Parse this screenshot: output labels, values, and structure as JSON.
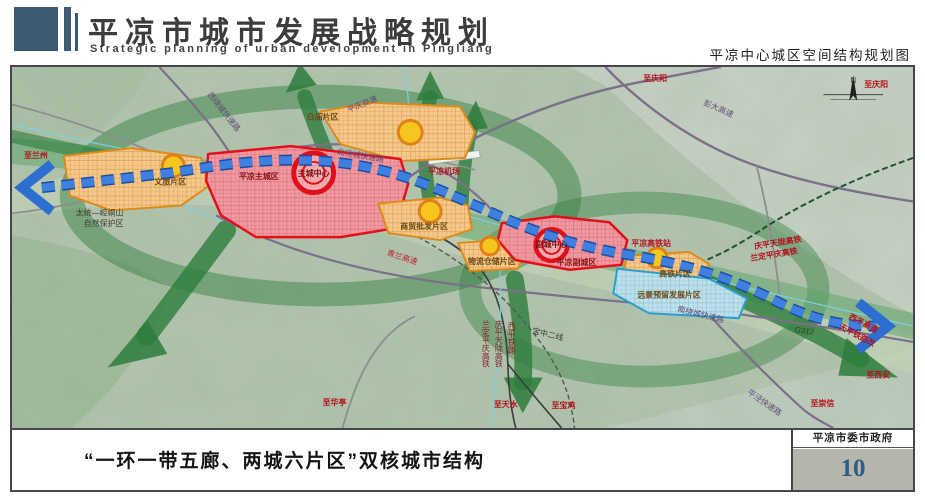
{
  "header": {
    "title": "平凉市城市发展战略规划",
    "subtitle_en": "Strategic planning of urban development in Pingliang",
    "map_title": "平凉中心城区空间结构规划图"
  },
  "footer": {
    "caption": "“一环一带五廊、两城六片区”双核城市结构",
    "agency": "平凉市委市政府",
    "page_number": "10"
  },
  "colors": {
    "axis_blue": "#2d6fd0",
    "corridor_green": "#2e7d3c",
    "zone_red": "#e3101a",
    "zone_orange": "#de8a1a",
    "zone_blue": "#2a9fd0",
    "node_yellow": "#f6c61e",
    "page_number_blue": "#2d5c85"
  },
  "map": {
    "structure_concept": "一环一带五廊、两城六片区",
    "labels": [
      {
        "name": "label-to-lanzhou",
        "text": "至兰州",
        "x": 12,
        "y": 92,
        "cls": "red"
      },
      {
        "name": "label-west-ring-expwy",
        "text": "西绕城快速路",
        "x": 196,
        "y": 28,
        "cls": "purple",
        "rot": 52,
        "size": 7
      },
      {
        "name": "label-pingqing-expwy",
        "text": "平庆高速",
        "x": 338,
        "y": 46,
        "cls": "purple",
        "rot": -22,
        "size": 7
      },
      {
        "name": "label-to-qingyang-n",
        "text": "至庆阳",
        "x": 634,
        "y": 14,
        "cls": "red"
      },
      {
        "name": "label-pengda-expwy",
        "text": "彭大高速",
        "x": 694,
        "y": 38,
        "cls": "purple",
        "rot": 24,
        "size": 7
      },
      {
        "name": "label-to-qingyang-ne",
        "text": "至庆阳",
        "x": 856,
        "y": 20,
        "cls": "red"
      },
      {
        "name": "label-airport",
        "text": "平凉机场",
        "x": 418,
        "y": 108,
        "cls": "red"
      },
      {
        "name": "label-zone-baimiao",
        "text": "白庙片区",
        "x": 296,
        "y": 53,
        "cls": "zone"
      },
      {
        "name": "label-north-ring-expwy",
        "text": "北绕城快速路",
        "x": 326,
        "y": 88,
        "cls": "purple",
        "rot": 10,
        "size": 6.5
      },
      {
        "name": "label-main-city",
        "text": "平凉主城区",
        "x": 228,
        "y": 113,
        "cls": "zonered",
        "size": 9.5
      },
      {
        "name": "label-main-center",
        "text": "主城中心",
        "x": 303,
        "y": 110,
        "cls": "center",
        "anchor": "middle",
        "size": 6.5
      },
      {
        "name": "label-zone-wenlv",
        "text": "文旅片区",
        "x": 143,
        "y": 119,
        "cls": "zone",
        "size": 7.5
      },
      {
        "name": "label-nature-reserve-1",
        "text": "太统—崆峒山",
        "x": 64,
        "y": 150,
        "cls": "dark"
      },
      {
        "name": "label-nature-reserve-2",
        "text": "自然保护区",
        "x": 72,
        "y": 161,
        "cls": "dark"
      },
      {
        "name": "label-qinglan-expwy",
        "text": "青兰高速",
        "x": 376,
        "y": 190,
        "cls": "redroad",
        "rot": 18,
        "size": 7.5
      },
      {
        "name": "label-zone-shangmao",
        "text": "商贸批发片区",
        "x": 390,
        "y": 164,
        "cls": "zone",
        "size": 7.5
      },
      {
        "name": "label-zone-wuliu",
        "text": "物流仓储片区",
        "x": 458,
        "y": 199,
        "cls": "zone",
        "size": 7
      },
      {
        "name": "label-sub-city",
        "text": "平凉副城区",
        "x": 547,
        "y": 200,
        "cls": "zonered",
        "size": 8.5
      },
      {
        "name": "label-sub-center",
        "text": "副城中心",
        "x": 542,
        "y": 182,
        "cls": "center",
        "anchor": "middle",
        "size": 6
      },
      {
        "name": "label-hsr-station",
        "text": "平凉高铁站",
        "x": 622,
        "y": 181,
        "cls": "red"
      },
      {
        "name": "label-hsr-qptl",
        "text": "庆平天陇高铁",
        "x": 746,
        "y": 184,
        "cls": "red",
        "rot": -9,
        "size": 7
      },
      {
        "name": "label-hsr-ldpq",
        "text": "兰定平庆高铁",
        "x": 742,
        "y": 196,
        "cls": "red",
        "rot": -9,
        "size": 7
      },
      {
        "name": "label-zone-gaotie",
        "text": "高铁片区",
        "x": 650,
        "y": 212,
        "cls": "zone",
        "size": 7.5
      },
      {
        "name": "label-zone-reserved",
        "text": "远景预留发展片区",
        "x": 628,
        "y": 233,
        "cls": "zone",
        "size": 7.5
      },
      {
        "name": "label-south-ring-expwy",
        "text": "南绕城快速路",
        "x": 668,
        "y": 247,
        "cls": "purple",
        "rot": 14,
        "size": 7
      },
      {
        "name": "label-g312",
        "text": "G312",
        "x": 786,
        "y": 268,
        "cls": "dark",
        "rot": 8
      },
      {
        "name": "label-xiping-expwy",
        "text": "西平高速",
        "x": 840,
        "y": 254,
        "cls": "red",
        "rot": 28,
        "size": 6.5
      },
      {
        "name": "label-tianping-rail",
        "text": "天平铁路改",
        "x": 830,
        "y": 264,
        "cls": "red",
        "rot": 28,
        "size": 6.5
      },
      {
        "name": "label-to-xian",
        "text": "至西安",
        "x": 858,
        "y": 314,
        "cls": "red"
      },
      {
        "name": "label-pingjing-expwy",
        "text": "平泾快速路",
        "x": 738,
        "y": 330,
        "cls": "purple",
        "rot": 35,
        "size": 7
      },
      {
        "name": "label-to-chongxin",
        "text": "至崇信",
        "x": 802,
        "y": 343,
        "cls": "red"
      },
      {
        "name": "label-to-huating",
        "text": "至华亭",
        "x": 312,
        "y": 342,
        "cls": "red"
      },
      {
        "name": "label-to-tianshui",
        "text": "至天水",
        "x": 484,
        "y": 344,
        "cls": "red"
      },
      {
        "name": "label-to-baoji",
        "text": "至宝鸡",
        "x": 542,
        "y": 345,
        "cls": "red"
      },
      {
        "name": "label-xiping-railway",
        "text": "西平铁路",
        "x": 502,
        "y": 258,
        "cls": "railv",
        "size": 6.5
      },
      {
        "name": "label-qptl-railway",
        "text": "庆平天陇高铁",
        "x": 489,
        "y": 256,
        "cls": "railv",
        "size": 6.5
      },
      {
        "name": "label-ldpq-railway",
        "text": "兰定平庆高铁",
        "x": 476,
        "y": 256,
        "cls": "railv",
        "size": 6.5
      },
      {
        "name": "label-baozhong-2",
        "text": "宝中二线",
        "x": 522,
        "y": 269,
        "cls": "dark",
        "rot": 14,
        "size": 7
      },
      {
        "name": "label-compass-n",
        "text": "N",
        "x": 845,
        "y": 16,
        "cls": "dark",
        "anchor": "middle",
        "size": 8
      }
    ]
  }
}
